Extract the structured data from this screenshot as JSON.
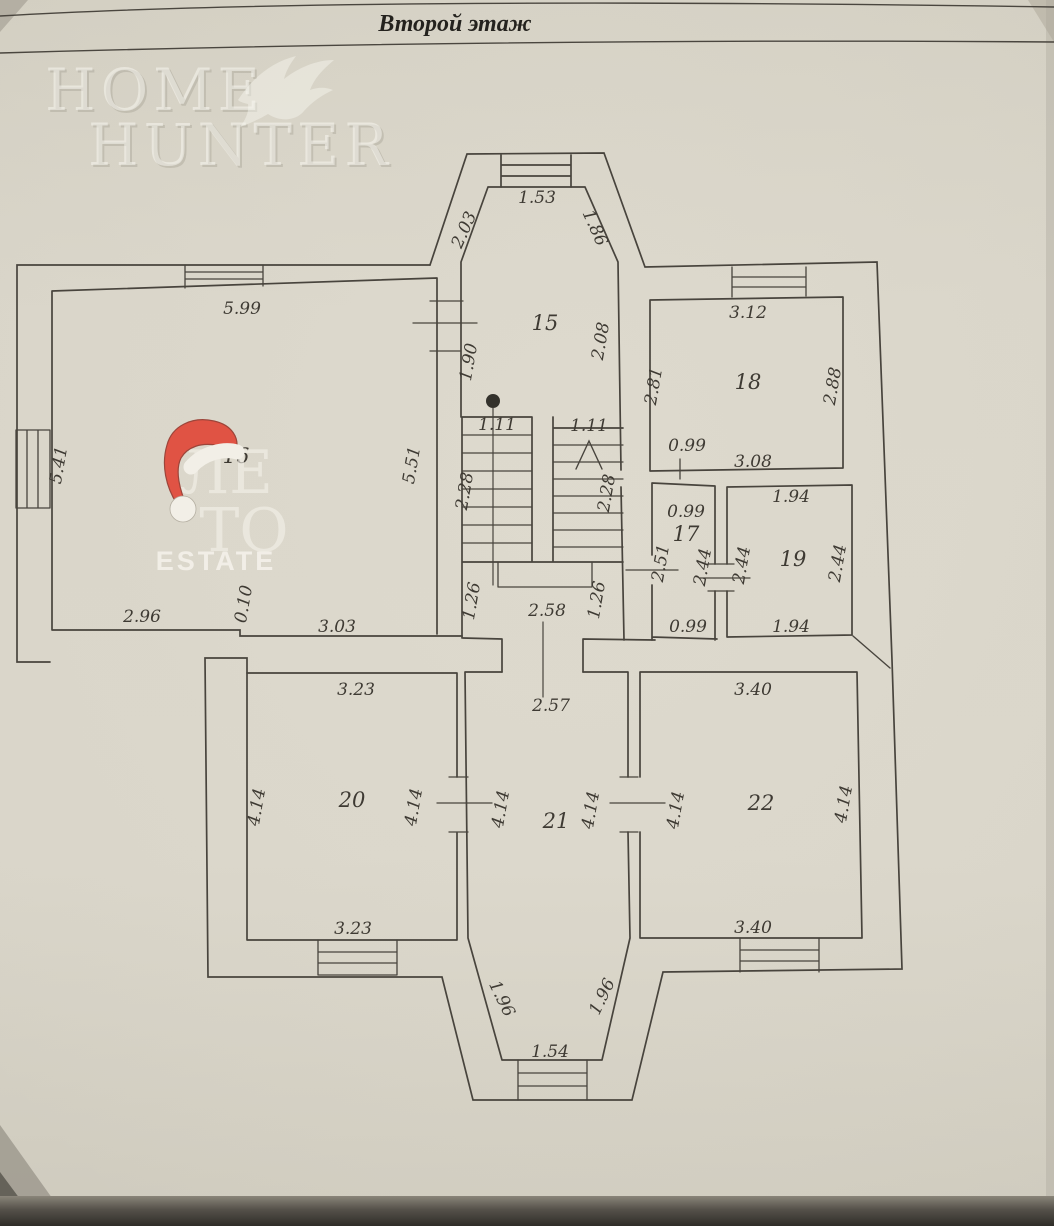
{
  "title": "Второй этаж",
  "watermark": {
    "word1": "HOME",
    "word2": "HUNTER",
    "icon": "eagle"
  },
  "logo": {
    "line1": "ЛЕ",
    "line2": "ТО",
    "caption": "ESTATE",
    "icon": "santa-hat"
  },
  "colors": {
    "paper": "#d7d3c7",
    "plan_line": "#48443d",
    "label_ink": "#3e3a33",
    "hat_red": "#e05344",
    "logo_white": "#f4f1e9"
  },
  "plan": {
    "rooms": [
      {
        "number": "15",
        "dims": {
          "top": "1.53",
          "left_diag": "2.03",
          "right_diag": "1.86",
          "left": "1.90",
          "right": "2.08"
        }
      },
      {
        "number": "16",
        "dims": {
          "top": "5.99",
          "left": "5.41",
          "right": "5.51",
          "bottom_left": "2.96",
          "step": "0.10",
          "bottom_right": "3.03"
        }
      },
      {
        "number": "17",
        "dims": {
          "top": "0.99",
          "left": "2.51",
          "right": "2.44",
          "bottom": "0.99"
        }
      },
      {
        "number": "18",
        "dims": {
          "top": "3.12",
          "left": "2.81",
          "right": "2.88",
          "bottom": "3.08",
          "door": "0.99"
        }
      },
      {
        "number": "19",
        "dims": {
          "top": "1.94",
          "left": "2.44",
          "right": "2.44",
          "bottom": "1.94"
        }
      },
      {
        "number": "20",
        "dims": {
          "top": "3.23",
          "left": "4.14",
          "right": "4.14",
          "bottom": "3.23"
        }
      },
      {
        "number": "21",
        "dims": {
          "top": "2.57",
          "left": "4.14",
          "right": "4.14"
        }
      },
      {
        "number": "22",
        "dims": {
          "top": "3.40",
          "left": "4.14",
          "right": "4.14",
          "bottom": "3.40"
        }
      }
    ],
    "stairs": {
      "width_left": "1.11",
      "width_right": "1.11",
      "run_left": "2.28",
      "run_right": "2.28",
      "below_left": "1.26",
      "below_width": "2.58",
      "below_right": "1.26"
    },
    "porch": {
      "left": "1.96",
      "right": "1.96",
      "bottom": "1.54"
    }
  }
}
